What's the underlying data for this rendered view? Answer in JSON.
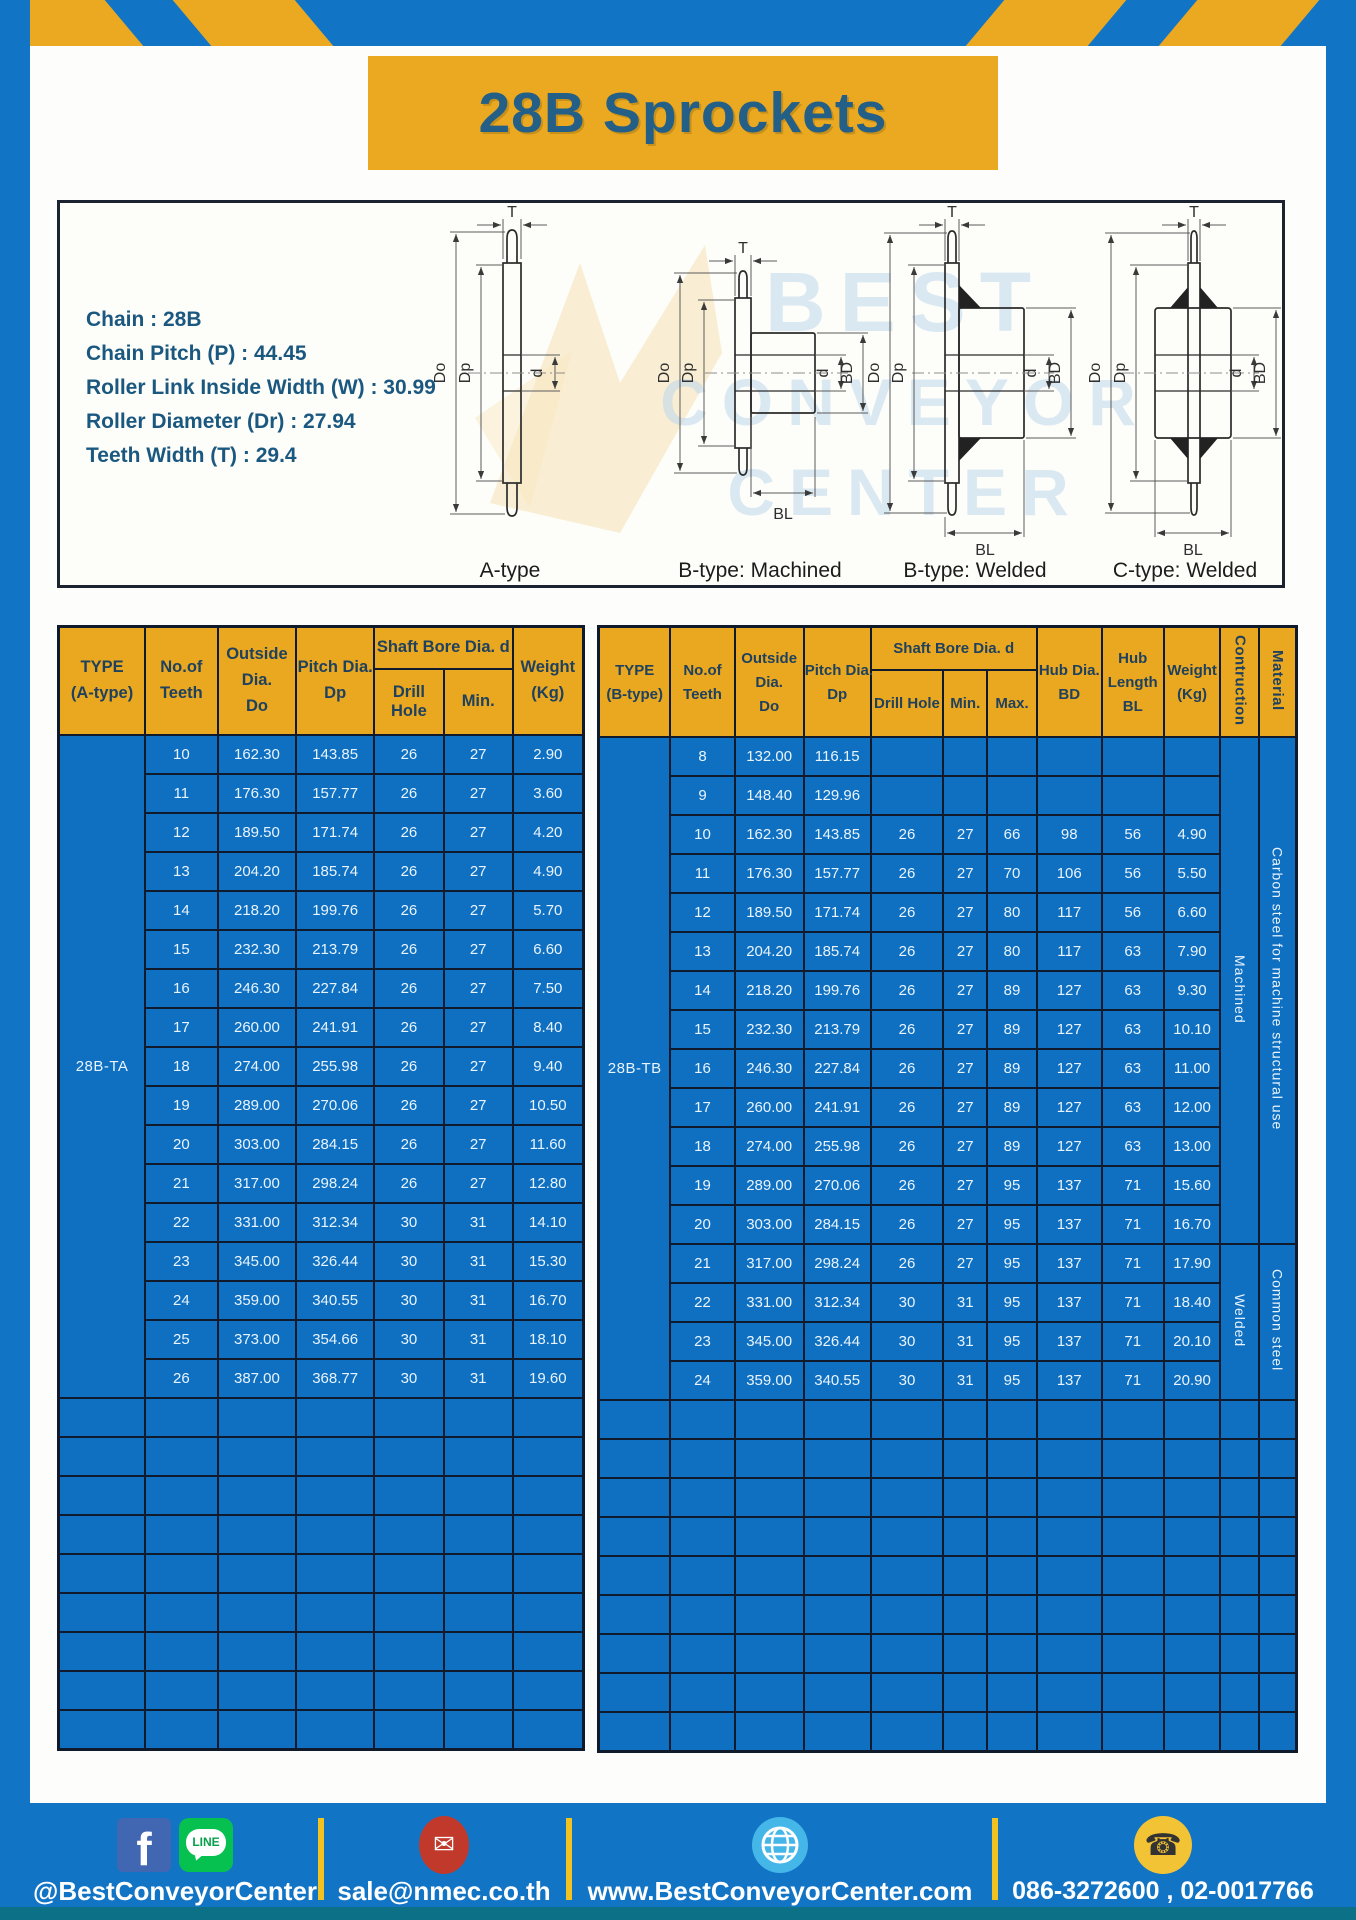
{
  "page": {
    "title": "28B Sprockets"
  },
  "specs": {
    "lines": [
      "Chain : 28B",
      "Chain Pitch (P) : 44.45",
      "Roller Link Inside Width (W) : 30.99",
      "Roller Diameter (Dr) : 27.94",
      "Teeth Width (T) : 29.4"
    ]
  },
  "drawings": {
    "watermark": [
      "BEST",
      "CONVEYOR",
      "CENTER"
    ],
    "captions": [
      "A-type",
      "B-type: Machined",
      "B-type: Welded",
      "C-type: Welded"
    ],
    "dims": {
      "t": "T",
      "do": "Do",
      "dp": "Dp",
      "d": "d",
      "bd": "BD",
      "bl": "BL"
    }
  },
  "tables": {
    "a": {
      "headers": {
        "type": [
          "TYPE",
          "(A-type)"
        ],
        "teeth": [
          "No.of",
          "Teeth"
        ],
        "outside": [
          "Outside",
          "Dia.",
          "Do"
        ],
        "pitch": [
          "Pitch Dia.",
          "Dp"
        ],
        "shaft_bore": "Shaft Bore Dia. d",
        "drill": "Drill Hole",
        "min": "Min.",
        "weight": [
          "Weight",
          "(Kg)"
        ]
      },
      "total_cols": 7,
      "empty_rows": 9,
      "merges": [
        {
          "row": 0,
          "span": 17,
          "pos": "start",
          "text": "28B-TA",
          "name": "type-cell-28b-ta",
          "cls": "type-cell"
        }
      ],
      "rows": [
        [
          "10",
          "162.30",
          "143.85",
          "26",
          "27",
          "2.90"
        ],
        [
          "11",
          "176.30",
          "157.77",
          "26",
          "27",
          "3.60"
        ],
        [
          "12",
          "189.50",
          "171.74",
          "26",
          "27",
          "4.20"
        ],
        [
          "13",
          "204.20",
          "185.74",
          "26",
          "27",
          "4.90"
        ],
        [
          "14",
          "218.20",
          "199.76",
          "26",
          "27",
          "5.70"
        ],
        [
          "15",
          "232.30",
          "213.79",
          "26",
          "27",
          "6.60"
        ],
        [
          "16",
          "246.30",
          "227.84",
          "26",
          "27",
          "7.50"
        ],
        [
          "17",
          "260.00",
          "241.91",
          "26",
          "27",
          "8.40"
        ],
        [
          "18",
          "274.00",
          "255.98",
          "26",
          "27",
          "9.40"
        ],
        [
          "19",
          "289.00",
          "270.06",
          "26",
          "27",
          "10.50"
        ],
        [
          "20",
          "303.00",
          "284.15",
          "26",
          "27",
          "11.60"
        ],
        [
          "21",
          "317.00",
          "298.24",
          "26",
          "27",
          "12.80"
        ],
        [
          "22",
          "331.00",
          "312.34",
          "30",
          "31",
          "14.10"
        ],
        [
          "23",
          "345.00",
          "326.44",
          "30",
          "31",
          "15.30"
        ],
        [
          "24",
          "359.00",
          "340.55",
          "30",
          "31",
          "16.70"
        ],
        [
          "25",
          "373.00",
          "354.66",
          "30",
          "31",
          "18.10"
        ],
        [
          "26",
          "387.00",
          "368.77",
          "30",
          "31",
          "19.60"
        ]
      ]
    },
    "b": {
      "headers": {
        "type": [
          "TYPE",
          "(B-type)"
        ],
        "teeth": [
          "No.of",
          "Teeth"
        ],
        "outside": [
          "Outside",
          "Dia.",
          "Do"
        ],
        "pitch": [
          "Pitch Dia.",
          "Dp"
        ],
        "shaft_bore": "Shaft Bore Dia. d",
        "drill": "Drill Hole",
        "min": "Min.",
        "max": "Max.",
        "hub_dia": [
          "Hub Dia.",
          "BD"
        ],
        "hub_len": [
          "Hub",
          "Length",
          "BL"
        ],
        "weight": [
          "Weight",
          "(Kg)"
        ],
        "construction": "Contruction",
        "material": "Material"
      },
      "total_cols": 12,
      "empty_rows": 9,
      "merges": [
        {
          "row": 0,
          "span": 17,
          "pos": "start",
          "text": "28B-TB",
          "name": "type-cell-28b-tb",
          "cls": "type-cell"
        },
        {
          "row": 0,
          "span": 13,
          "pos": "end",
          "text": "Machined",
          "name": "construction-machined",
          "vertical": true
        },
        {
          "row": 0,
          "span": 13,
          "pos": "end",
          "text": "Carbon steel for machine structural use",
          "name": "material-carbon-steel",
          "vertical": true
        },
        {
          "row": 13,
          "span": 4,
          "pos": "end",
          "text": "Welded",
          "name": "construction-welded",
          "vertical": true
        },
        {
          "row": 13,
          "span": 4,
          "pos": "end",
          "text": "Common steel",
          "name": "material-common-steel",
          "vertical": true
        }
      ],
      "rows": [
        [
          "8",
          "132.00",
          "116.15",
          "",
          "",
          "",
          "",
          "",
          ""
        ],
        [
          "9",
          "148.40",
          "129.96",
          "",
          "",
          "",
          "",
          "",
          ""
        ],
        [
          "10",
          "162.30",
          "143.85",
          "26",
          "27",
          "66",
          "98",
          "56",
          "4.90"
        ],
        [
          "11",
          "176.30",
          "157.77",
          "26",
          "27",
          "70",
          "106",
          "56",
          "5.50"
        ],
        [
          "12",
          "189.50",
          "171.74",
          "26",
          "27",
          "80",
          "117",
          "56",
          "6.60"
        ],
        [
          "13",
          "204.20",
          "185.74",
          "26",
          "27",
          "80",
          "117",
          "63",
          "7.90"
        ],
        [
          "14",
          "218.20",
          "199.76",
          "26",
          "27",
          "89",
          "127",
          "63",
          "9.30"
        ],
        [
          "15",
          "232.30",
          "213.79",
          "26",
          "27",
          "89",
          "127",
          "63",
          "10.10"
        ],
        [
          "16",
          "246.30",
          "227.84",
          "26",
          "27",
          "89",
          "127",
          "63",
          "11.00"
        ],
        [
          "17",
          "260.00",
          "241.91",
          "26",
          "27",
          "89",
          "127",
          "63",
          "12.00"
        ],
        [
          "18",
          "274.00",
          "255.98",
          "26",
          "27",
          "89",
          "127",
          "63",
          "13.00"
        ],
        [
          "19",
          "289.00",
          "270.06",
          "26",
          "27",
          "95",
          "137",
          "71",
          "15.60"
        ],
        [
          "20",
          "303.00",
          "284.15",
          "26",
          "27",
          "95",
          "137",
          "71",
          "16.70"
        ],
        [
          "21",
          "317.00",
          "298.24",
          "26",
          "27",
          "95",
          "137",
          "71",
          "17.90"
        ],
        [
          "22",
          "331.00",
          "312.34",
          "30",
          "31",
          "95",
          "137",
          "71",
          "18.40"
        ],
        [
          "23",
          "345.00",
          "326.44",
          "30",
          "31",
          "95",
          "137",
          "71",
          "20.10"
        ],
        [
          "24",
          "359.00",
          "340.55",
          "30",
          "31",
          "95",
          "137",
          "71",
          "20.90"
        ]
      ]
    }
  },
  "footer": {
    "facebook_glyph": "f",
    "line_glyph": "LINE",
    "mail_glyph": "✉",
    "phone_glyph": "☎",
    "social_label": "@BestConveyorCenter",
    "email_label": "sale@nmec.co.th",
    "website_label": "www.BestConveyorCenter.com",
    "phone_label": "086-3272600 , 02-0017766"
  }
}
